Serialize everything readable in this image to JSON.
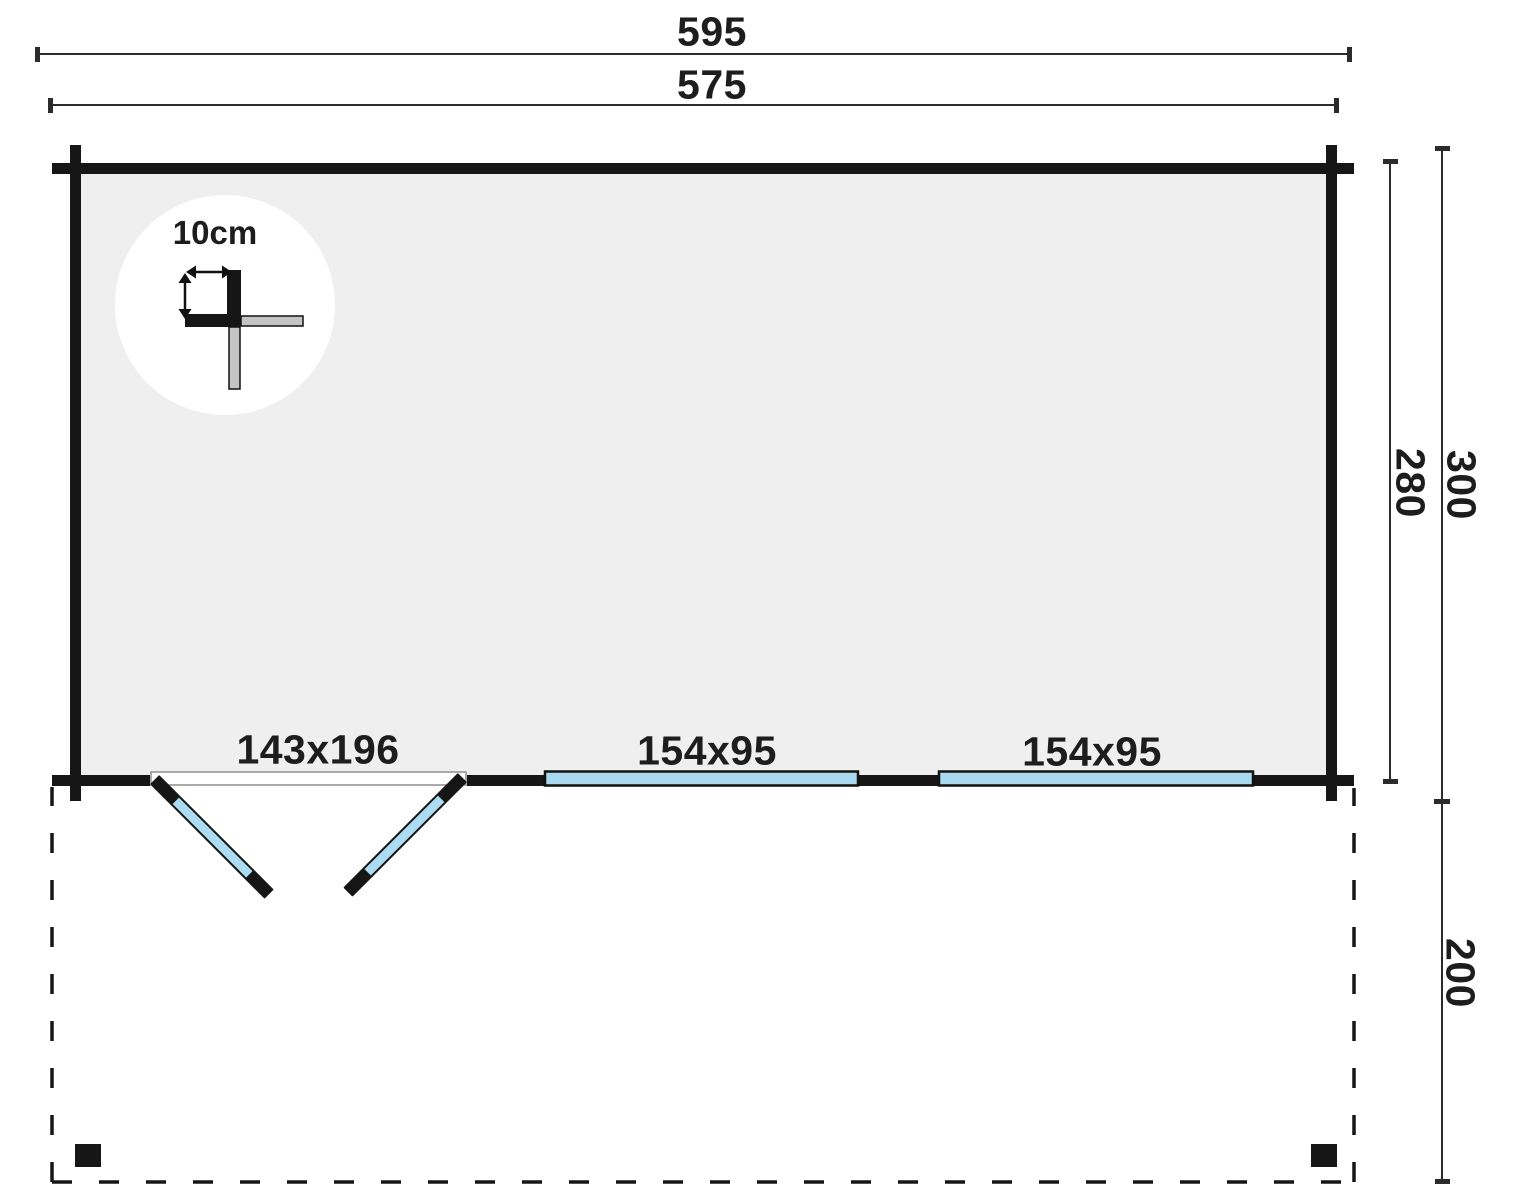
{
  "plan": {
    "kind": "log-cabin-floor-plan-with-terrace"
  },
  "labels": {
    "width_overall": "595",
    "width_walls": "575",
    "depth_inner": "280",
    "depth_overall": "300",
    "depth_terrace": "200",
    "door": "143x196",
    "window_a": "154x95",
    "window_b": "154x95",
    "log_thickness": "10cm"
  },
  "colors": {
    "wall_black": "#161616",
    "interior_grey": "#efefef",
    "glazing_blue": "#a8d9ef",
    "door_blue": "#abdcf2",
    "detail_grey": "#c4c4c4",
    "dimension_line": "#2b2b2b",
    "threshold_outline": "#8f8f8f",
    "text": "#1d1d1d",
    "background": "#ffffff"
  }
}
